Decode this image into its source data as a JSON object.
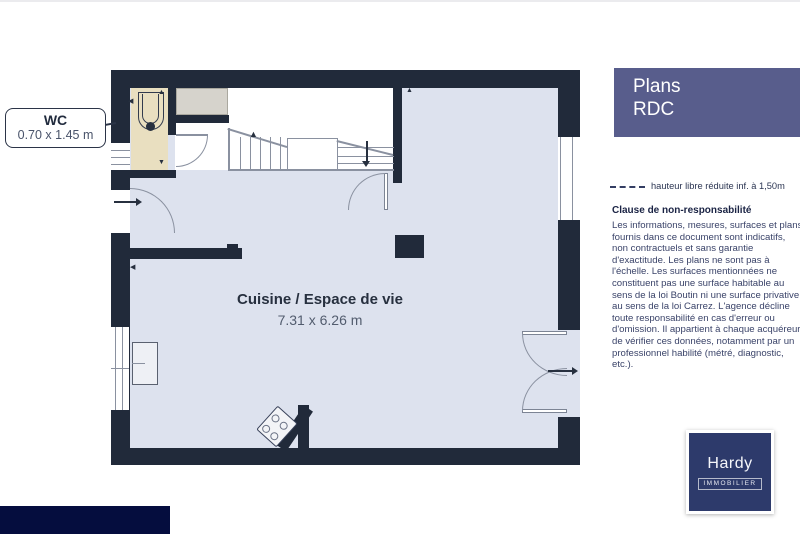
{
  "plan": {
    "wc": {
      "label": "WC",
      "dims": "0.70 x 1.45 m"
    },
    "main_room": {
      "label": "Cuisine / Espace de vie",
      "dims": "7.31 x 6.26 m"
    }
  },
  "sidebar": {
    "title": {
      "line1": "Plans",
      "line2": "RDC"
    },
    "legend": {
      "label": "hauteur libre réduite inf. à 1,50m"
    },
    "disclaimer": {
      "title": "Clause de non-responsabilité",
      "body": "Les informations, mesures, surfaces et plans fournis dans ce document sont indicatifs, non contractuels et sans garantie d'exactitude. Les plans ne sont pas à l'échelle. Les surfaces mentionnées ne constituent pas une surface habitable au sens de la loi Boutin ni une surface privative au sens de la loi Carrez. L'agence décline toute responsabilité en cas d'erreur ou d'omission. Il appartient à chaque acquéreur de vérifier ces données, notamment par un professionnel habilité (métré, diagnostic, etc.)."
    },
    "logo": {
      "name": "Hardy",
      "sub": "IMMOBILIER"
    }
  },
  "colors": {
    "wall": "#212a3a",
    "floor": "#dde2ee",
    "wc_floor": "#e9dfc0",
    "closet": "#d6d3cc",
    "accent": "#585d8c",
    "brand_navy": "#2d3a6b",
    "footer_navy": "#050d3e",
    "ink": "#27303f",
    "muted": "#525c6e",
    "line": "#8a91a0"
  }
}
